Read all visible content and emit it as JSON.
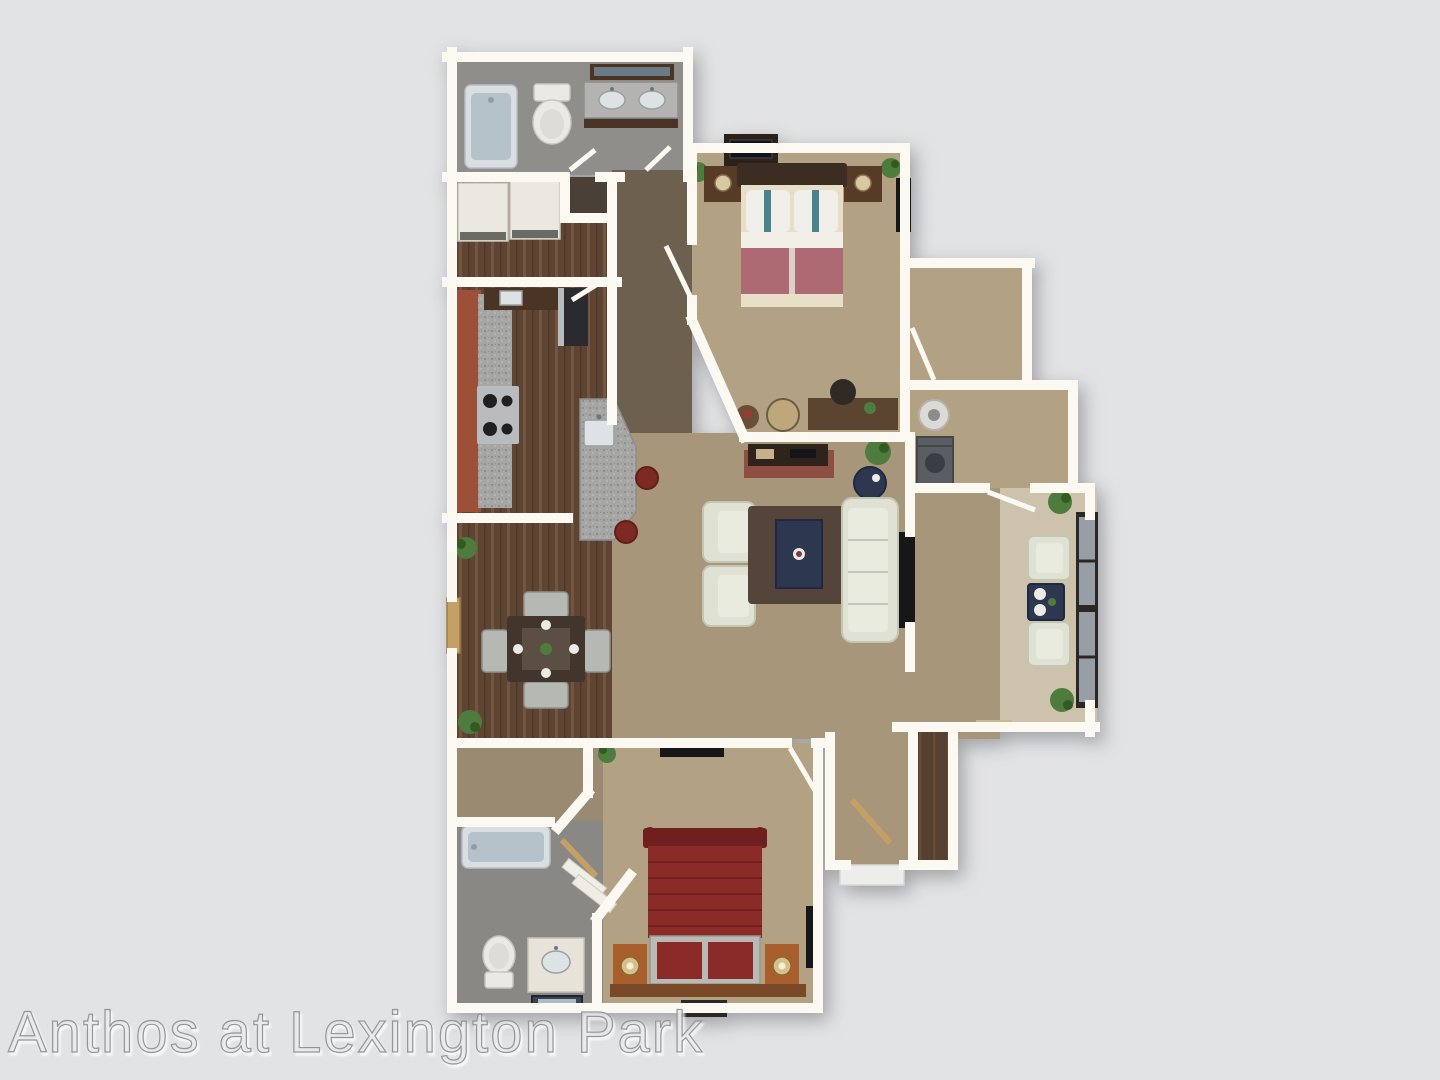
{
  "watermark": "Anthos at Lexington Park",
  "colors": {
    "background": "#e2e3e5",
    "wall": "#fbf9f2",
    "carpetLiving": "#a8967a",
    "carpetBedroom": "#b3a183",
    "hallTaupe": "#6e604e",
    "woodFloor": "#5e4433",
    "woodPlank": "#7a5a41",
    "closetWood": "#56402f",
    "bathFloor": "#908e8b",
    "bathFloor2": "#8a8885",
    "vestibule": "#9b8a72",
    "patioFloor": "#cdc2ab",
    "brick": "#9d5038",
    "granite": "#a6a6a4",
    "graniteDot1": "#807f7d",
    "graniteDot2": "#c6c6c4",
    "stainless": "#b9bcbe",
    "stoveBlack": "#202020",
    "fridgeDark": "#2b2b2f",
    "stoolRed": "#7c2a22",
    "counterDark": "#4a3424",
    "sinkWhite": "#dde2e4",
    "tubRim": "#d8dee2",
    "tubBlue": "#b5c2ca",
    "toiletWhite": "#eae9e5",
    "vanityCream": "#e7e3d9",
    "mirrorBrown": "#4a3424",
    "dresserWhite": "#eae8e1",
    "bed1Headboard": "#3b2d21",
    "bed1Cream": "#e8dfc9",
    "bed1Mauve": "#ad6a72",
    "pillowWhite": "#f1efe9",
    "pillowTeal": "#47858a",
    "nightstand1": "#573b27",
    "lampCream": "#d9c9a2",
    "tvDark": "#17171a",
    "deskBrown": "#5b4430",
    "chairDark": "#2e2a26",
    "poufTan": "#bfa77c",
    "tableWood": "#6a4e36",
    "sofaCream": "#dfe2d3",
    "sofaLine": "#c2c6b3",
    "sofaInner": "#e9ebdf",
    "rugBrown": "#54443a",
    "tableNavy": "#2d3850",
    "diningTable": "#42352c",
    "diningRunner": "#5b4e42",
    "chairSilver": "#b6b9b3",
    "plateWhite": "#edebe5",
    "plantGreen": "#4d7c3c",
    "plantDark": "#335a20",
    "doorTan": "#c5a066",
    "bed2Red": "#8b2b27",
    "bed2Dark": "#6f1f1d",
    "benchGray": "#b9b9b5",
    "nightstand2": "#a95f2c",
    "lampGold": "#d8c089",
    "woodBase": "#7a4a28",
    "washerGray": "#5a5e63",
    "heaterWhite": "#dcdad6",
    "windowFrame": "#2b2724",
    "windowGlass": "#aab4bd",
    "ledgeTrim": "#c9b98e",
    "landing": "#ededeb",
    "watermarkStroke": "#96969a",
    "watermarkFill": "rgba(227,228,230,0.6)"
  }
}
